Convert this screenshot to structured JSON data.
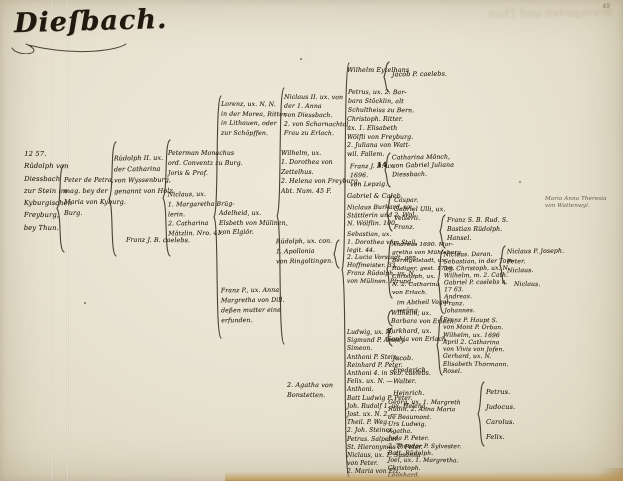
{
  "page": {
    "title": "Dieſbach.",
    "page_number": "49",
    "showthrough_text": "Bremgarten und Thun"
  },
  "entries": {
    "root": {
      "text": "12 57.\nRüdolph von\nDiessbach\nzur Stein im\nKyburgischen\nFreyburg,\nbey Thun."
    },
    "peter_de_petra": {
      "text": "Peter de Petra,\nmag. bey der\nMaria von Kyburg.\nBurg."
    },
    "rudolph_ii": {
      "text": "Rüdolph II. ux.\nder Catharina\nvon Wyssenburg,\ngenannt von Holz."
    },
    "franz_caelebs": {
      "text": "Franz J. B. caelebs."
    },
    "peterman": {
      "text": "Peterman Monachus\nord. Conventz zu Burg.\nJoris & Prof."
    },
    "niclaus_bruegglerin": {
      "text": "Niclaus, ux.\n1. Margaretha Brüg-\nlerin.\n2. Catharina\nMätzlin. Nro. 41."
    },
    "lorenz": {
      "text": "Lorenz, ux. N. N.\nin der Morea, Ritter\nin Lithauen, oder\nzur Schöpffen."
    },
    "adelheid": {
      "text": "Adelheid, ux.\nElsbeth von Mülinen,\nvon Elgiör."
    },
    "franz_dill": {
      "text": "Franz P., ux. Anna\nMargretha von Dill.\ndeßen mutter eine\nerfunden."
    },
    "niclaus_ii": {
      "text": "Niclaus II. ux. von\nder 1. Anna\nvon Diessbach.\n2. von Scharnachtal,\nFrau zu Erlach."
    },
    "wilhelm_zettelhus": {
      "text": "Wilhelm, ux.\n1. Dorothea von\nZettelhus.\n2. Helena von Freyburg.\nAbt. Num. 45 F."
    },
    "rudolph_ringoltingen": {
      "text": "Rüdolph, ux. con.\n1. Apollonia\nvon Ringoltingen."
    },
    "agatha": {
      "text": "2. Agatha von\nBonstetten."
    },
    "wilhelm_eytelhans": {
      "text": "Wilhelm Eytelhans"
    },
    "jacob_caelebs": {
      "text": "Jacob P. caelebs."
    },
    "petrus_stoecklin": {
      "text": "Petrus, ux. 2. Bar-\nbara Stöcklin, alt\nSchultheiss zu Bern."
    },
    "christoph_ritter": {
      "text": "Christoph. Ritter.\nux. 1. Elisabeth\nWölfli von Freyburg.\n2. Juliana von Watt-\nwil. Fallem."
    },
    "franz_lepzig": {
      "text": "Franz J. B. ux.\n1696.\nvon Lepzig."
    },
    "num_14": {
      "text": "14"
    },
    "catharina_moench": {
      "text": "Catharina Mönch,\nvon Gabriel Juliana\nDiessbach."
    },
    "gabriel_caleb": {
      "text": "Gabriel & Caleb."
    },
    "niclaus_burkard": {
      "text": "Niclaus Burkard, ux.\nStättlerin und 2. Wol.\nN. Wölflin. 100."
    },
    "sebastian_stall": {
      "text": "Sebastian, ux.\n1. Dorothea vom Stall.\nlegit. 44.\n2. Lucia Vorstadt, gen.\nHoffmeister. 33.\nFranz Rüdolph, ux. N.\nvon Mülinen. Pfrund."
    },
    "ludwig_list": {
      "text": "Ludwig, ux. N.\nSigmund P. Amrey.\nSimeon.\nAnthoni P. Stein.\nReinhard P. Peter.\nAnthoni 4. in Seb. caelebs.\nFelix. ux. N. —\nAnthoni.\nBatt Ludwig P. Peter.\nJoh. Rudolf 1. ux. Helena.\nJost. ux. N. 2. —\nTheil. P. Weg.\n2. Joh. Steiner.\nPetrus. Salpeter.\nSt. Hieronymus P. Peter.\nNiclaus, ux. 1. Susanna\nvon Peter.\n2. Maria von Elz."
    },
    "caspar_group": {
      "text": "Caspar.\nGabriel Ulli, ux.\nVelserli.\nFranz."
    },
    "andreas_group": {
      "text": "Andreas 1690. Mar-\ngretha von Mühleberg.\nBernigelstadt, ux.\nRüdiger, gest. 1710.\nChristoph, ux.\nN. 2. Catharina\nvon Erlach."
    },
    "abtheil_note": {
      "text": "im Abtheil Vogel-\nweüng."
    },
    "wilhelm_barbara": {
      "text": "Wilhelm, ux.\nBarbara von Erlach."
    },
    "burkhard_sophia": {
      "text": "Burkhard, ux.\nSophia von Erlach."
    },
    "jacob_list": {
      "text": "Jacob.\nFrederich.\nWalter.\nHeinrich."
    },
    "georg_list": {
      "text": "Georg, ux. 1. Margreth\nRüdin. 2. Anna Maria\nde Beaumont.\nUrs Ludwig.\nAgatha.\nJuda P. Peter.\n2. Theodor P. Sylvester.\nBatt. Rüdolph.\nJoel, ux. 1. Margretha.\nChristoph.\nLeonhard."
    },
    "franz_rud_group": {
      "text": "Franz S. B. Rud. S.\nBastian Rüdolph.\nHansel."
    },
    "niclaus_sebastian_list": {
      "text": "Niclaus. Daran.\nSebastian, in der Tom-\nley. Christoph, ux. N.\nWilhelm, m. 2. Cath.\nGabriel P. caelebs n.\n17 63.\nAndreas.\nFranz.\nJohannes."
    },
    "franz_haupt_group": {
      "text": "Franz P. Haupt S.\nvon Mont P. Orban.\nWilhelm, ux. 1696\nApril 2. Catharina\nvon Vivis von Jofen.\nGerhard, ux. N.\nElisabeth Thormann.\nRosel."
    },
    "petrus_judocus_list": {
      "text": "Petrus.\nJudocus.\nCarolus.\nFelix."
    },
    "niclaus_joseph_list": {
      "text": "Niclaus P. Joseph.\nPeter.\nNiclaus."
    },
    "niclaus_single": {
      "text": "Niclaus."
    },
    "marginal_note": {
      "text": "Maria Anna Theresia\nvon Wattenwyl."
    }
  }
}
